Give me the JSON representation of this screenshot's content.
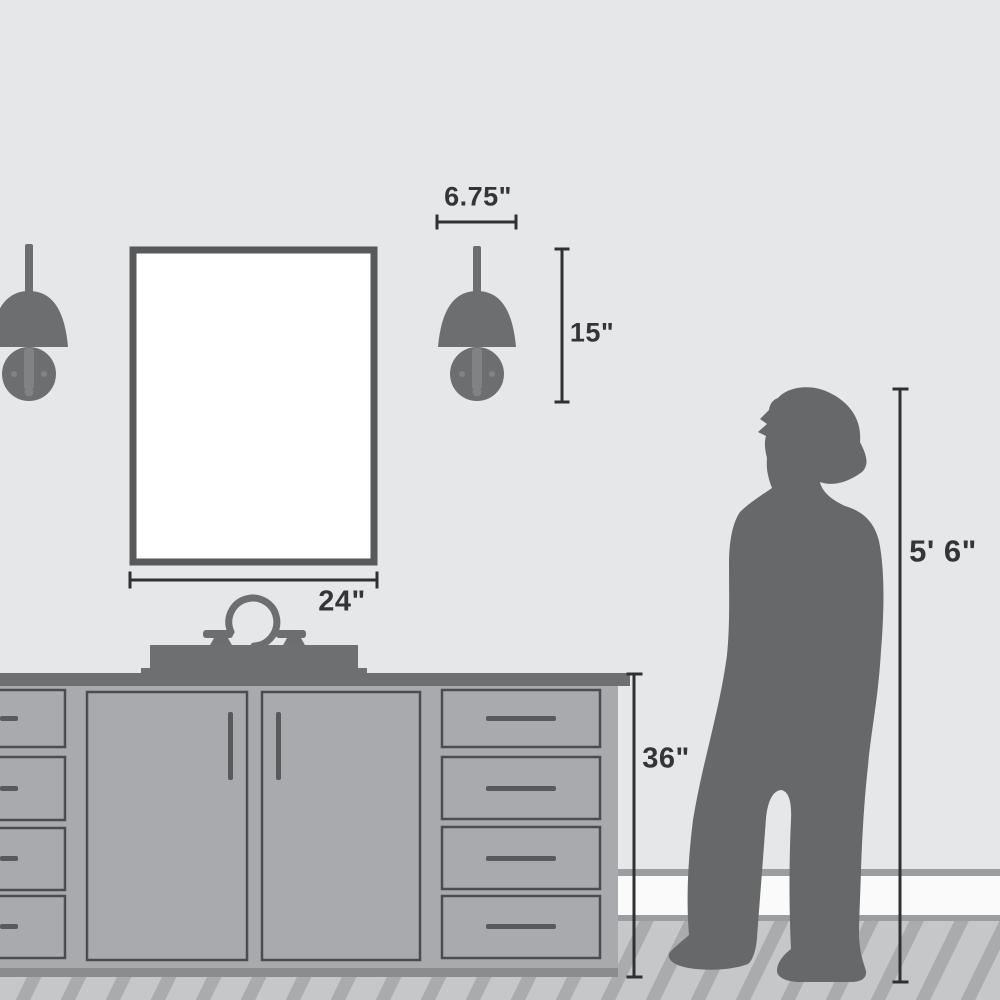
{
  "diagram": {
    "description": "Bathroom scale diagram comparing a wall sconce, mirror and vanity to a person",
    "labels": {
      "sconce_width": "6.75\"",
      "sconce_height": "15\"",
      "mirror_width": "24\"",
      "vanity_height": "36\"",
      "person_height": "5' 6\""
    },
    "objects": {
      "sconce_left": "wall sconce (partially cropped)",
      "sconce_right": "wall sconce",
      "mirror": "rectangular mirror",
      "vanity": "bathroom vanity cabinet with widespread faucet",
      "person": "woman silhouette standing on wood floor"
    },
    "colors": {
      "wall": "#e6e7e8",
      "silhouette": "#67686a",
      "fixture": "#6c6e70",
      "plate-detail": "#808285",
      "cabinet": "#a8aaad",
      "cabinet-outline": "#4b4c4e",
      "counter": "#6d6f71",
      "handle": "#58595b",
      "toe-kick": "#8a8c8e",
      "floor": "#c6c7c9",
      "floor-stripe": "#a9abad",
      "baseboard": "#fafafa",
      "baseboard-trim": "#9b9da0",
      "dimension-line": "#2f3032",
      "dimension-text": "#333537",
      "mirror-frame": "#58595b",
      "mirror-glass": "#ffffff"
    }
  }
}
